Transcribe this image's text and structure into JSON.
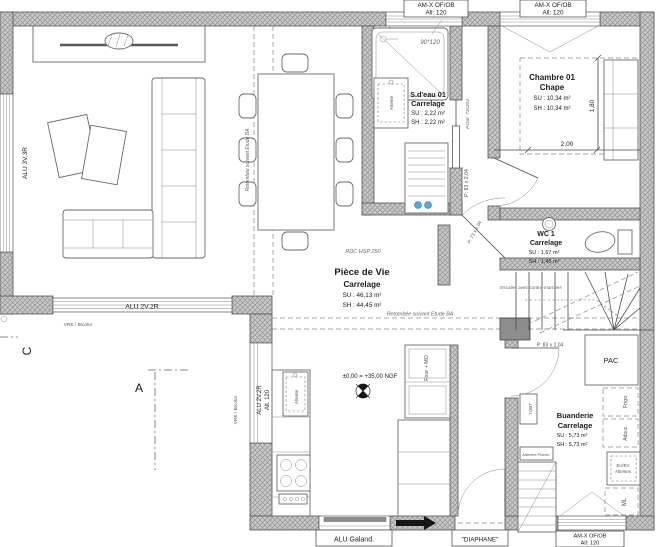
{
  "plan": {
    "w": {
      "amx": "AM-X OF/OB",
      "all": "All: 120",
      "left": "ALU 3V.3R",
      "south": "ALU 2V.2R",
      "west1": "ALU 2V.2R",
      "west2": "Alt. 120",
      "slide": "ALU Galand.",
      "entry": "\"DIAPHANE\"",
      "sill": "VRE / Bicolor"
    },
    "rooms": {
      "sdeau": {
        "name": "S.d'eau 01",
        "finish": "Carrelage",
        "su": "SU : 2,22 m²",
        "sh": "SH : 2,22 m²"
      },
      "chambre": {
        "name": "Chambre 01",
        "finish": "Chape",
        "su": "SU : 10,34 m²",
        "sh": "SH : 10,34 m²"
      },
      "wc": {
        "name": "WC 1",
        "finish": "Carrelage",
        "su": "SU : 1,67 m²",
        "sh": "SH : 1,45 m²"
      },
      "vie": {
        "name": "Pièce de Vie",
        "finish": "Carrelage",
        "su": "SU : 46,13 m²",
        "sh": "SH : 44,45 m²"
      },
      "buand": {
        "name": "Buanderie",
        "finish": "Carrelage",
        "su": "SU : 5,73 m²",
        "sh": "SH : 5,73 m²"
      }
    },
    "doors": {
      "pocket": "P.Gal. 73x204",
      "p83": "P: 83 x 2,04",
      "p73": "P: 73 x 2,04"
    },
    "eq": {
      "pac": "PAC",
      "frigo": "Frigo",
      "adouc": "Adouc.",
      "ml": "ML",
      "tgbt": "TGBT",
      "four": "Four + MO",
      "attente": "Attente",
      "att1": "EU/EV",
      "att2": "Attentes",
      "plumb": "Attentes Plomb."
    },
    "ann": {
      "level": "±0,00 = +35,00 NGF",
      "rdc": "RDC HSP 250",
      "beam": "Retombée suivant Etude BA",
      "stairs": "Escalier avec contre-marches",
      "shower": "90*120",
      "d180": "1,80",
      "d200": "2,00",
      "secC": "C",
      "secA": "A"
    }
  }
}
